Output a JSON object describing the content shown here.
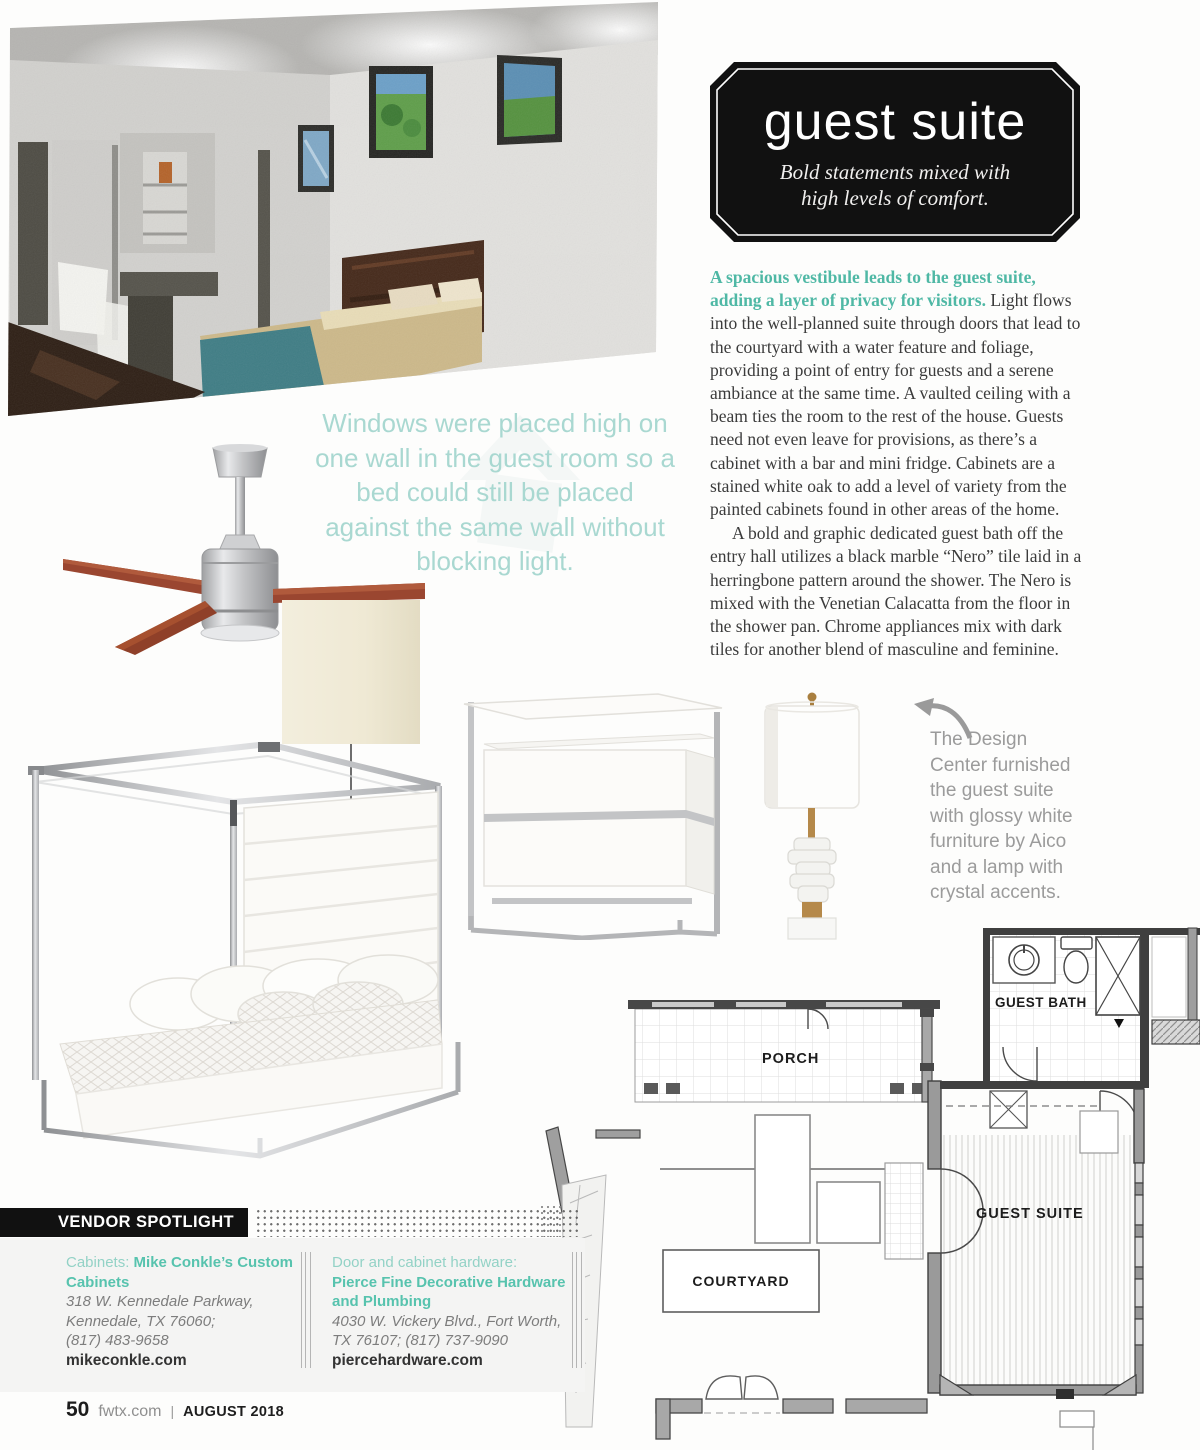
{
  "badge": {
    "title": "guest suite",
    "subtitle_line1": "Bold statements mixed with",
    "subtitle_line2": "high levels of comfort."
  },
  "article": {
    "lead": "A spacious vestibule leads to the guest suite, adding a layer of privacy for visitors.",
    "para1": " Light flows into the well-planned suite through doors that lead to the courtyard with a water feature and foliage, providing a point of entry for guests and a serene ambiance at the same time. A vaulted ceiling with a beam ties the room to the rest of the house. Guests need not even leave for provisions, as there’s a cabinet with a bar and mini fridge. Cabinets are a stained white oak to add a level of variety from the painted cabinets found in other areas of the home.",
    "para2": "A bold and graphic dedicated guest bath off the entry hall utilizes a black marble “Nero” tile laid in a herringbone pattern around the shower. The Nero is mixed with the Venetian Calacatta from the floor in the shower pan. Chrome appliances mix with dark tiles for another blend of masculine and feminine."
  },
  "pull_quote": "Windows were placed high on one wall in the guest room so a bed could still be placed against the same wall without blocking light.",
  "design_caption": "The Design Center furnished the guest suite with glossy white furniture by Aico and a lamp with crystal accents.",
  "floor_plan": {
    "labels": {
      "porch": "PORCH",
      "guest_bath": "GUEST BATH",
      "guest_suite": "GUEST SUITE",
      "courtyard": "COURTYARD"
    }
  },
  "vendor": {
    "banner": "VENDOR SPOTLIGHT",
    "vendors": [
      {
        "category": "Cabinets: ",
        "name": "Mike Conkle’s Custom Cabinets",
        "address": [
          "318 W. Kennedale Parkway,",
          "Kennedale, TX 76060;",
          "(817) 483-9658"
        ],
        "website": "mikeconkle.com"
      },
      {
        "category": "Door and cabinet hardware: ",
        "name": "Pierce Fine Decorative Hardware and Plumbing",
        "address": [
          "4030 W. Vickery Blvd., Fort Worth,",
          "TX 76107; (817) 737-9090"
        ],
        "website": "piercehardware.com"
      }
    ]
  },
  "footer": {
    "page_number": "50",
    "site": "fwtx.com",
    "issue": "AUGUST 2018"
  },
  "colors": {
    "accent_teal": "#4fb8a5",
    "quote_teal": "#a9d8d1",
    "vendor_teal": "#57c3ae",
    "badge_black": "#111111"
  }
}
